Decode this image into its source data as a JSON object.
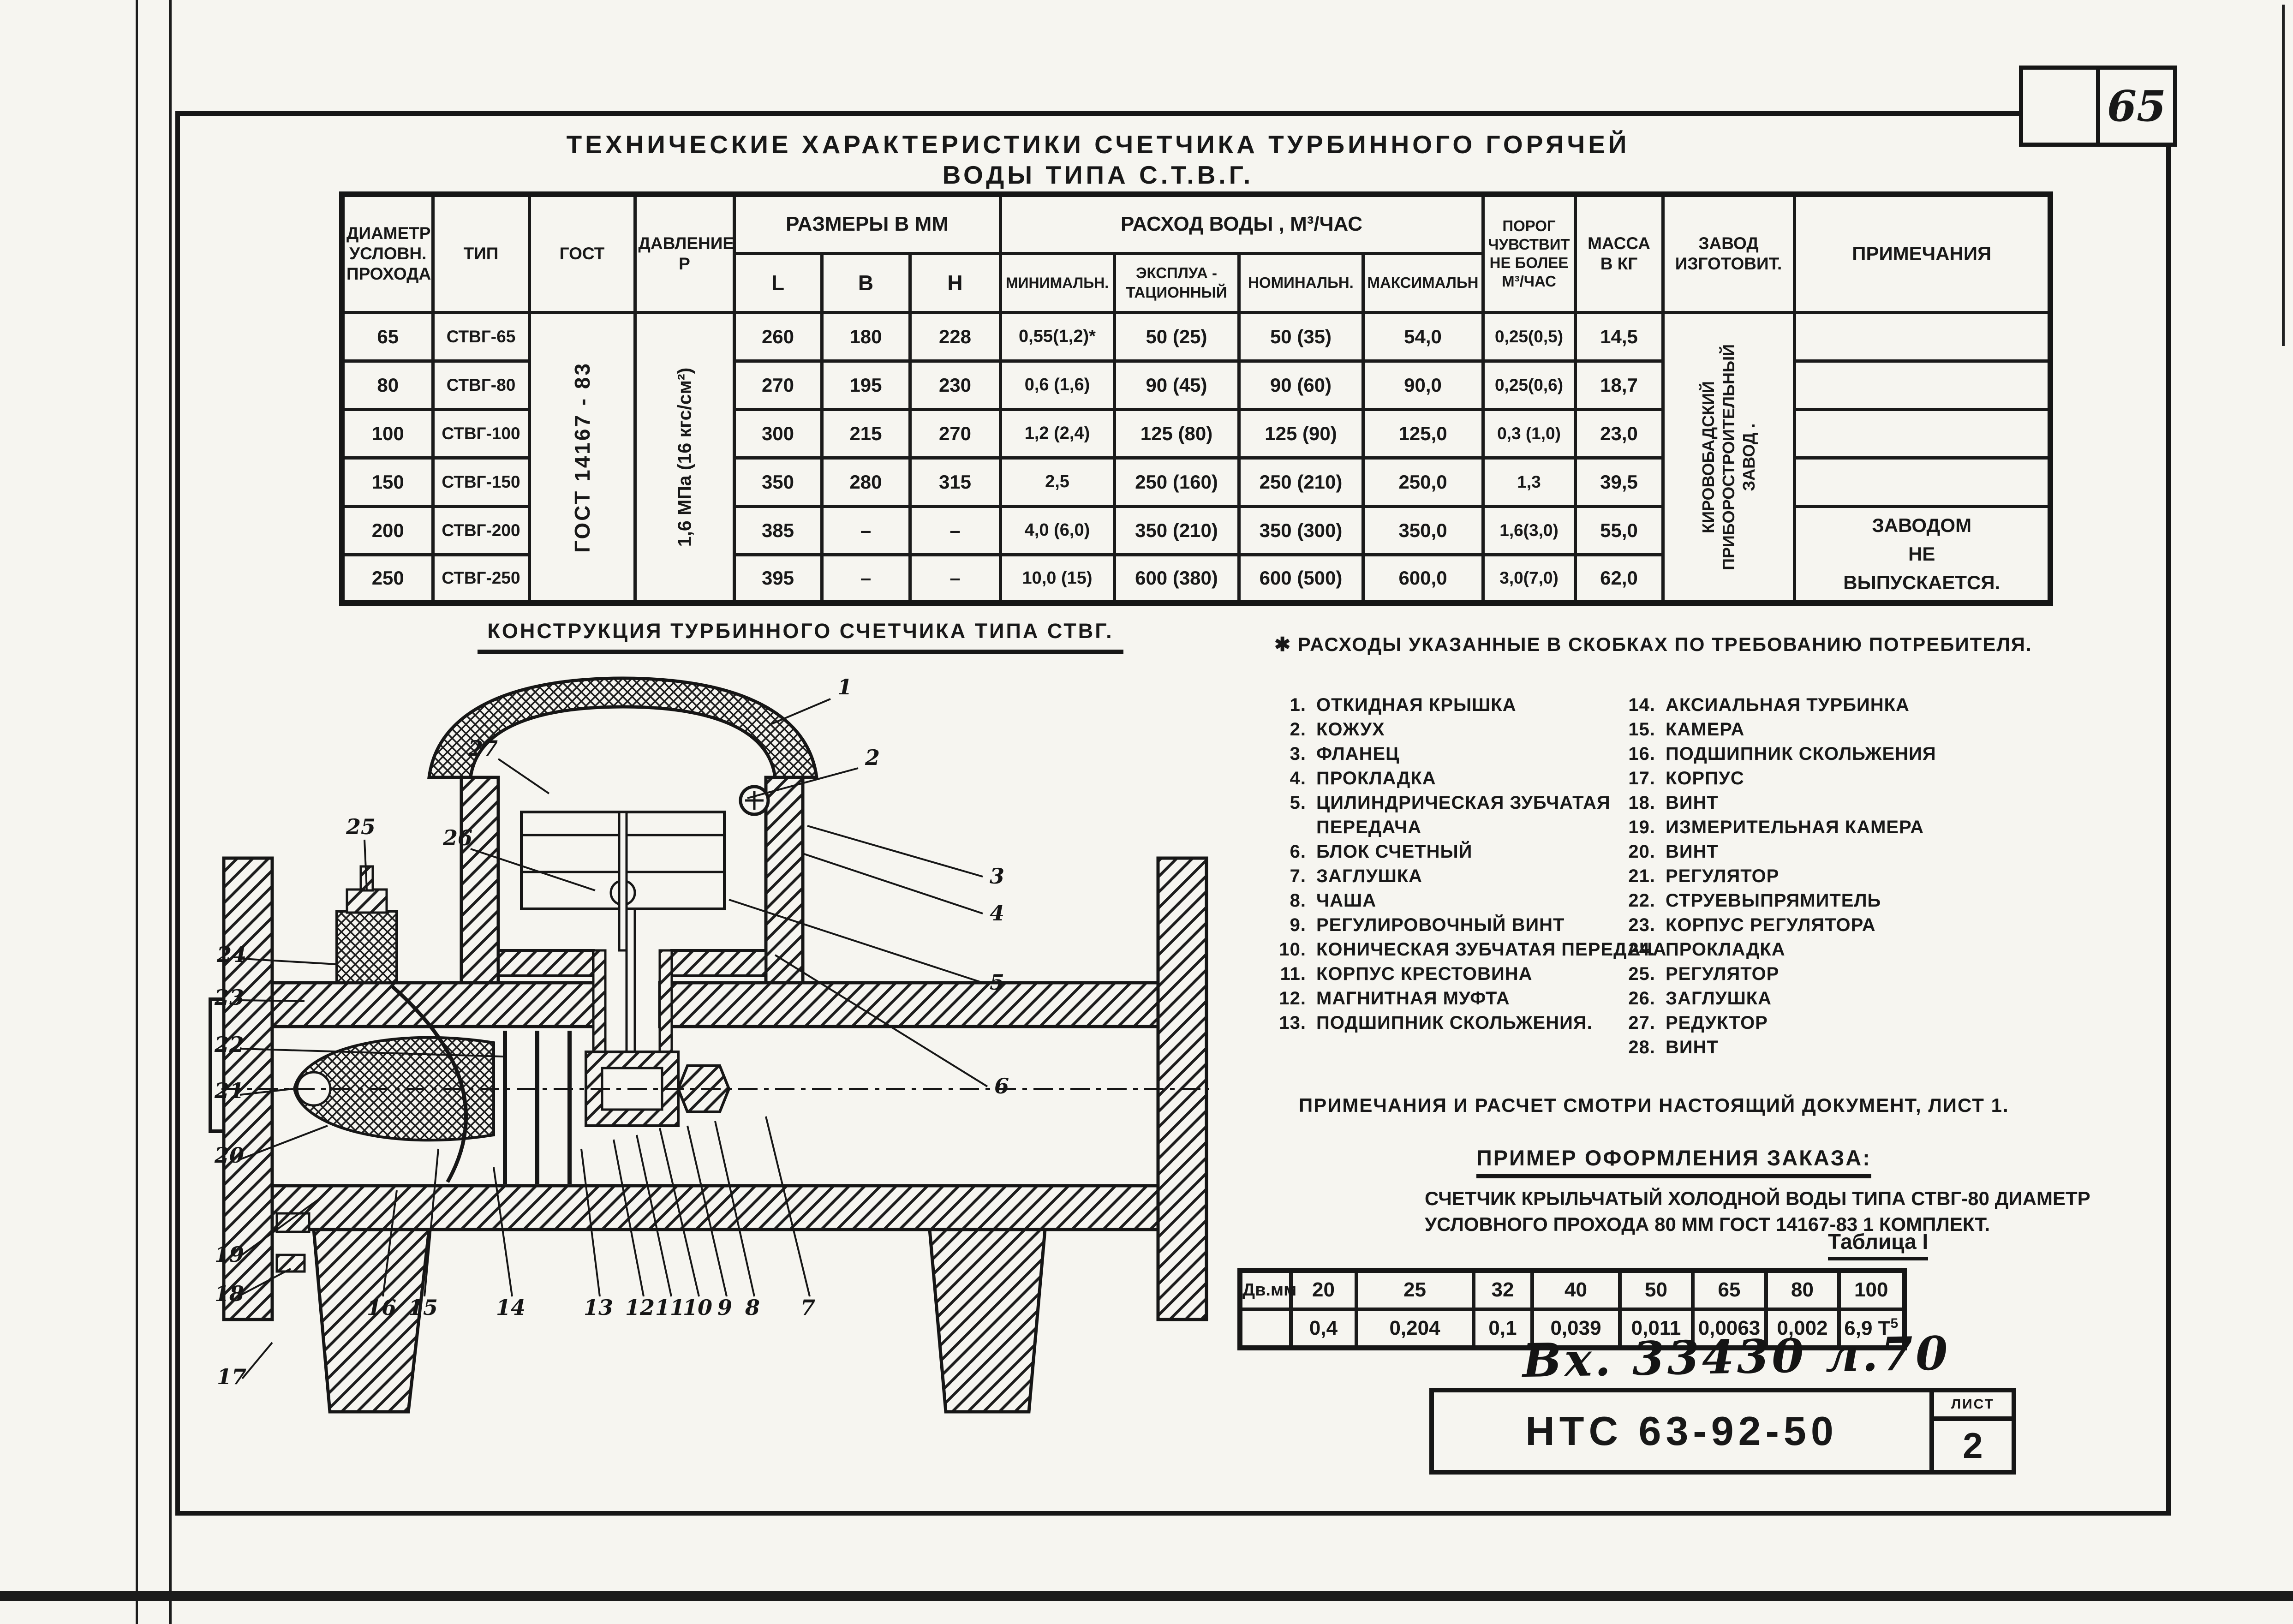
{
  "page": {
    "number": "65",
    "sheet_label": "ЛИСТ",
    "sheet_number": "2"
  },
  "title": "ТЕХНИЧЕСКИЕ  ХАРАКТЕРИСТИКИ  СЧЕТЧИКА  ТУРБИННОГО  ГОРЯЧЕЙ   ВОДЫ  ТИПА  С.Т.В.Г.",
  "spec": {
    "h": {
      "diameter": "ДИАМЕТР\nУСЛОВН.\nПРОХОДА",
      "type": "ТИП",
      "gost": "ГОСТ",
      "pressure": "ДАВЛЕНИЕ\nР",
      "dims": "РАЗМЕРЫ  В  ММ",
      "l": "L",
      "b": "В",
      "hh": "Н",
      "flow": "РАСХОД  ВОДЫ  ,    М³/ЧАС",
      "min": "МИНИМАЛЬН.",
      "oper": "ЭКСПЛУА -\nТАЦИОННЫЙ",
      "nom": "НОМИНАЛЬН.",
      "max": "МАКСИМАЛЬН",
      "threshold": "ПОРОГ\nЧУВСТВИТ\nНЕ БОЛЕЕ\nМ³/ЧАС",
      "mass": "МАССА\nВ КГ",
      "plant": "ЗАВОД\nИЗГОТОВИТ.",
      "notes": "ПРИМЕЧАНИЯ"
    },
    "gost_value": "ГОСТ 14167 - 83",
    "pressure_value": "1,6 МПа (16 кгс/см²)",
    "plant_value": "КИРОВОБАДСКИЙ ПРИБОРОСТРОИТЕЛЬНЫЙ ЗАВОД .",
    "notes_value": "ЗАВОДОМ\nНЕ\nВЫПУСКАЕТСЯ.",
    "rows": [
      [
        "65",
        "СТВГ-65",
        "260",
        "180",
        "228",
        "0,55(1,2)*",
        "50  (25)",
        "50  (35)",
        "54,0",
        "0,25(0,5)",
        "14,5"
      ],
      [
        "80",
        "СТВГ-80",
        "270",
        "195",
        "230",
        "0,6  (1,6)",
        "90  (45)",
        "90  (60)",
        "90,0",
        "0,25(0,6)",
        "18,7"
      ],
      [
        "100",
        "СТВГ-100",
        "300",
        "215",
        "270",
        "1,2  (2,4)",
        "125 (80)",
        "125 (90)",
        "125,0",
        "0,3 (1,0)",
        "23,0"
      ],
      [
        "150",
        "СТВГ-150",
        "350",
        "280",
        "315",
        "2,5",
        "250 (160)",
        "250 (210)",
        "250,0",
        "1,3",
        "39,5"
      ],
      [
        "200",
        "СТВГ-200",
        "385",
        "–",
        "–",
        "4,0  (6,0)",
        "350 (210)",
        "350 (300)",
        "350,0",
        "1,6(3,0)",
        "55,0"
      ],
      [
        "250",
        "СТВГ-250",
        "395",
        "–",
        "–",
        "10,0  (15)",
        "600 (380)",
        "600 (500)",
        "600,0",
        "3,0(7,0)",
        "62,0"
      ]
    ]
  },
  "drawing": {
    "title": "КОНСТРУКЦИЯ  ТУРБИННОГО  СЧЕТЧИКА  ТИПА  СТВГ.",
    "labels": [
      "1",
      "2",
      "3",
      "4",
      "5",
      "6",
      "7",
      "8",
      "9",
      "10",
      "11",
      "12",
      "13",
      "14",
      "15",
      "16",
      "17",
      "18",
      "19",
      "20",
      "21",
      "22",
      "23",
      "24",
      "25",
      "26",
      "27",
      "28"
    ]
  },
  "footnote": "✱ РАСХОДЫ  УКАЗАННЫЕ  В СКОБКАХ  ПО ТРЕБОВАНИЮ  ПОТРЕБИТЕЛЯ.",
  "parts": {
    "left": [
      {
        "n": "1.",
        "t": "ОТКИДНАЯ  КРЫШКА"
      },
      {
        "n": "2.",
        "t": "КОЖУХ"
      },
      {
        "n": "3.",
        "t": "ФЛАНЕЦ"
      },
      {
        "n": "4.",
        "t": "ПРОКЛАДКА"
      },
      {
        "n": "5.",
        "t": "ЦИЛИНДРИЧЕСКАЯ ЗУБЧАТАЯ\nПЕРЕДАЧА"
      },
      {
        "n": "6.",
        "t": "БЛОК  СЧЕТНЫЙ"
      },
      {
        "n": "7.",
        "t": "ЗАГЛУШКА"
      },
      {
        "n": "8.",
        "t": "ЧАША"
      },
      {
        "n": "9.",
        "t": "РЕГУЛИРОВОЧНЫЙ  ВИНТ"
      },
      {
        "n": "10.",
        "t": "КОНИЧЕСКАЯ ЗУБЧАТАЯ ПЕРЕДАЧА"
      },
      {
        "n": "11.",
        "t": "КОРПУС  КРЕСТОВИНА"
      },
      {
        "n": "12.",
        "t": "МАГНИТНАЯ  МУФТА"
      },
      {
        "n": "13.",
        "t": "ПОДШИПНИК  СКОЛЬЖЕНИЯ."
      }
    ],
    "right": [
      {
        "n": "14.",
        "t": "АКСИАЛЬНАЯ  ТУРБИНКА"
      },
      {
        "n": "15.",
        "t": "КАМЕРА"
      },
      {
        "n": "16.",
        "t": "ПОДШИПНИК  СКОЛЬЖЕНИЯ"
      },
      {
        "n": "17.",
        "t": "КОРПУС"
      },
      {
        "n": "18.",
        "t": "ВИНТ"
      },
      {
        "n": "19.",
        "t": "ИЗМЕРИТЕЛЬНАЯ  КАМЕРА"
      },
      {
        "n": "20.",
        "t": "ВИНТ"
      },
      {
        "n": "21.",
        "t": "РЕГУЛЯТОР"
      },
      {
        "n": "22.",
        "t": "СТРУЕВЫПРЯМИТЕЛЬ"
      },
      {
        "n": "23.",
        "t": "КОРПУС  РЕГУЛЯТОРА"
      },
      {
        "n": "24.",
        "t": "ПРОКЛАДКА"
      },
      {
        "n": "25.",
        "t": "РЕГУЛЯТОР"
      },
      {
        "n": "26.",
        "t": "ЗАГЛУШКА"
      },
      {
        "n": "27.",
        "t": "РЕДУКТОР"
      },
      {
        "n": "28.",
        "t": "ВИНТ"
      }
    ]
  },
  "note_line": "ПРИМЕЧАНИЯ   И  РАСЧЕТ  СМОТРИ  НАСТОЯЩИЙ  ДОКУМЕНТ, ЛИСТ  1.",
  "order": {
    "title": "ПРИМЕР  ОФОРМЛЕНИЯ  ЗАКАЗА:",
    "body": "СЧЕТЧИК  КРЫЛЬЧАТЫЙ  ХОЛОДНОЙ  ВОДЫ  ТИПА  СТВГ-80   ДИАМЕТР\nУСЛОВНОГО  ПРОХОДА 80 ММ  ГОСТ 14167-83     1  КОМПЛЕКТ."
  },
  "table1": {
    "caption": "Таблица I",
    "row_label": "Дв.мм",
    "columns": [
      "20",
      "25",
      "32",
      "40",
      "50",
      "65",
      "80",
      "100"
    ],
    "values": [
      "0,4",
      "0,204",
      "0,1",
      "0,039",
      "0,011",
      "0,0063",
      "0,002",
      "6,9 Т"
    ],
    "last_sup": "5"
  },
  "stamp": {
    "handwritten": "Вх. 33430 л.70",
    "doc_number": "НТС 63-92-50"
  }
}
